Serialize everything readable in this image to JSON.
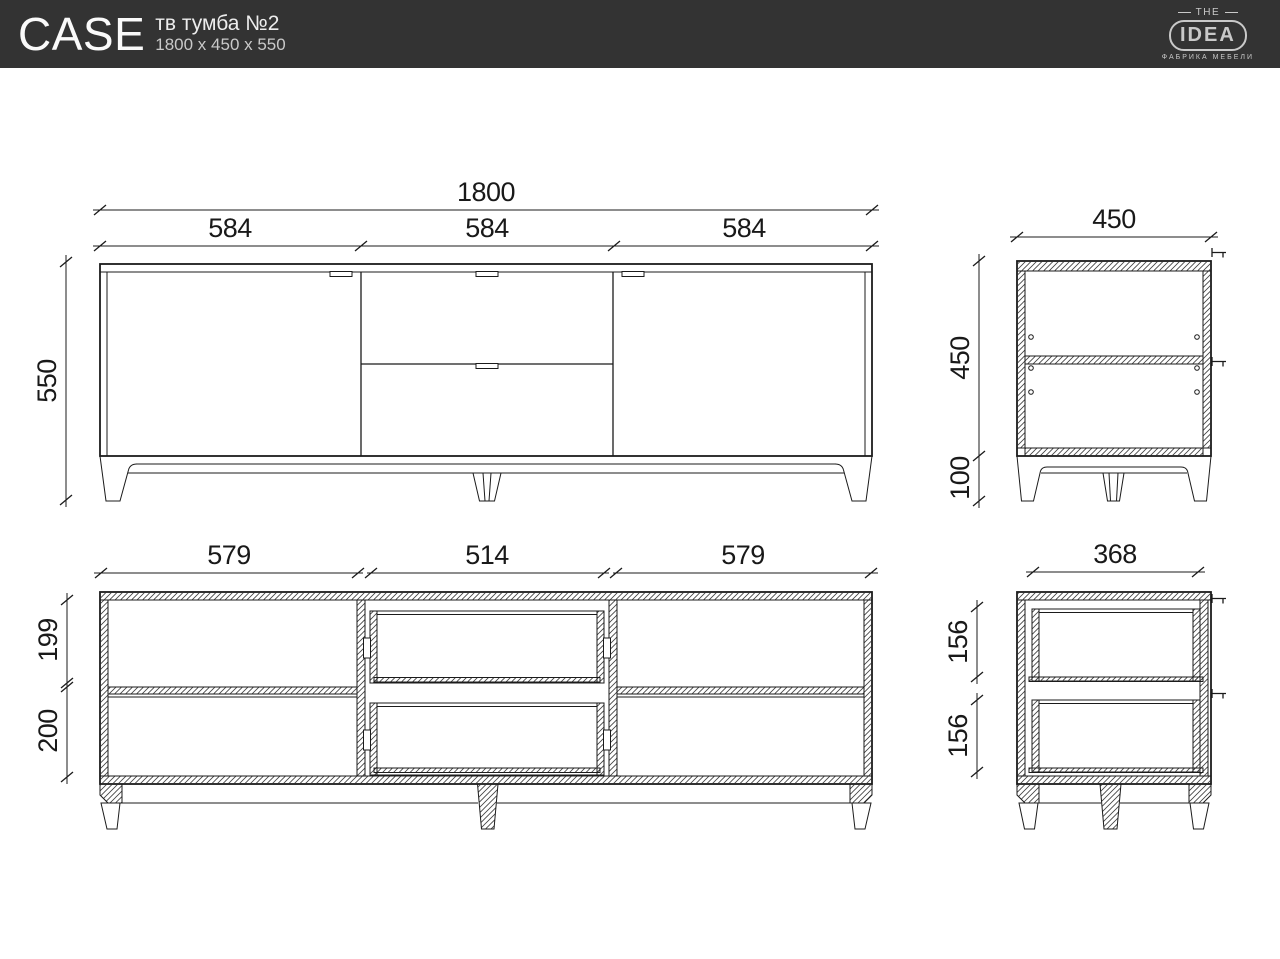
{
  "header": {
    "product_name": "CASE",
    "product_type": "тв тумба №2",
    "overall_dimensions": "1800 x 450 x 550"
  },
  "logo": {
    "top": "THE",
    "name": "IDEA",
    "tagline": "ФАБРИКА МЕБЕЛИ"
  },
  "colors": {
    "header_bg": "#333333",
    "drawing_line": "#1b1b1b",
    "logo_gray": "#c9c9c9"
  },
  "views": {
    "front": {
      "overall_width": "1800",
      "section_widths": [
        "584",
        "584",
        "584"
      ],
      "overall_height": "550"
    },
    "side": {
      "depth": "450",
      "body_height": "450",
      "leg_height": "100"
    },
    "front_section": {
      "interior_widths": [
        "579",
        "514",
        "579"
      ],
      "interior_heights": [
        "199",
        "200"
      ]
    },
    "side_section": {
      "drawer_depth": "368",
      "drawer_heights": [
        "156",
        "156"
      ]
    }
  }
}
